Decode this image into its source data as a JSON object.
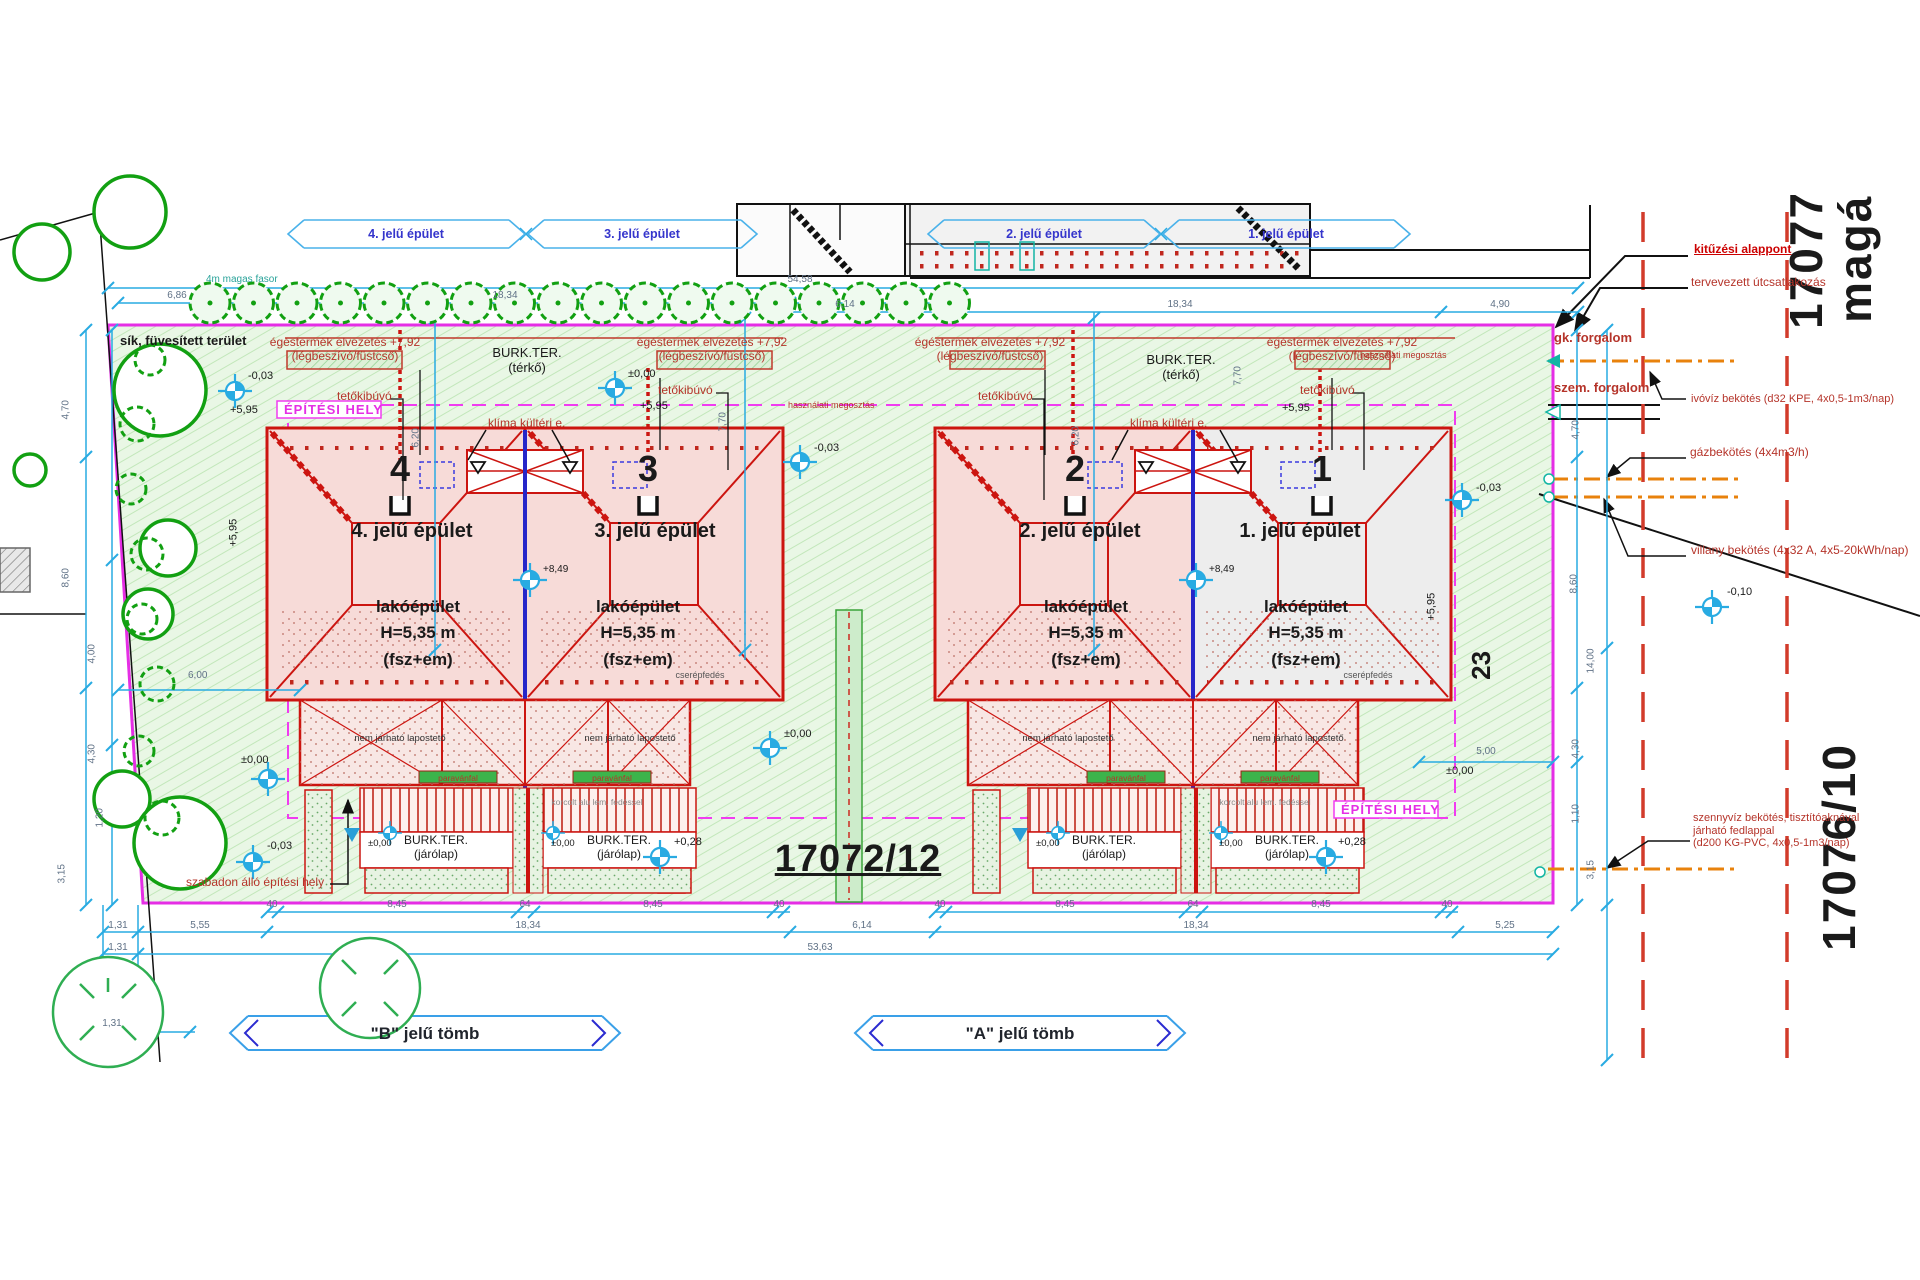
{
  "parcels": {
    "main": "17072/12",
    "right_top": "17077",
    "right_top2": "magá",
    "right_bottom": "17076/10",
    "neighbor": "23"
  },
  "callouts": {
    "b4": "4. jelű épület",
    "b3": "3. jelű épület",
    "b2": "2. jelű épület",
    "b1": "1. jelű épület"
  },
  "blocks": {
    "b": "\"B\" jelű tömb",
    "a": "\"A\" jelű tömb"
  },
  "buildings": [
    {
      "num": "4",
      "name": "4. jelű épület",
      "l1": "lakóépület",
      "l2": "H=5,35 m",
      "l3": "(fsz+em)"
    },
    {
      "num": "3",
      "name": "3. jelű épület",
      "l1": "lakóépület",
      "l2": "H=5,35 m",
      "l3": "(fsz+em)"
    },
    {
      "num": "2",
      "name": "2. jelű épület",
      "l1": "lakóépület",
      "l2": "H=5,35 m",
      "l3": "(fsz+em)"
    },
    {
      "num": "1",
      "name": "1. jelű épület",
      "l1": "lakóépület",
      "l2": "H=5,35 m",
      "l3": "(fsz+em)"
    }
  ],
  "site": {
    "grass": "sík, füvesített terület",
    "zone": "ÉPÍTÉSI HELY",
    "free": "szabadon álló építési hely",
    "tree_row": "4m magas fasor",
    "split": "használati megosztás",
    "terko1": "BURK.TER.",
    "terko2": "(térkő)",
    "jarolap1": "BURK.TER.",
    "jarolap2": "(járólap)",
    "flat": "nem járható lapostető",
    "tile": "cserépfedés",
    "alu": "korcolt alu lem. fedéssel",
    "screen": "paravánfal",
    "hatch": "tetőkibúvó",
    "flue1": "égéstermék elvezetés +7,92",
    "flue2": "(légbeszívó/füstcső)",
    "ac": "klíma kültéri e."
  },
  "utilities": {
    "setout": "kitűzési alappont",
    "road": "tervevezett útcsatlakozás",
    "car": "gk. forgalom",
    "ped": "szem. forgalom",
    "water": "ivóvíz bekötés (d32 KPE, 4x0,5-1m3/nap)",
    "gas": "gázbekötés (4x4m3/h)",
    "power": "villany bekötés (4x32 A, 4x5-20kWh/nap)",
    "sewer1": "szennyvíz bekötés, tisztítóaknával",
    "sewer2": "járható fedlappal",
    "sewer3": "(d200 KG-PVC, 4x0,5-1m3/nap)"
  },
  "levels": {
    "zero": "±0,00",
    "m003": "-0,03",
    "m010": "-0,10",
    "p028": "+0,28",
    "p595": "+5,95",
    "p849": "+8,49"
  },
  "dims": {
    "d40": "40",
    "d64": "64",
    "d845": "8,45",
    "d1834": "18,34",
    "d614": "6,14",
    "d131": "1,31",
    "d555": "5,55",
    "d5363": "53,63",
    "d525": "5,25",
    "d5458": "54,58",
    "d686": "6,86",
    "d490": "4,90",
    "d470": "4,70",
    "d860": "8,60",
    "d400": "4,00",
    "d430": "4,30",
    "d120": "1,20",
    "d315": "3,15",
    "d600": "6,00",
    "d620": "6,20",
    "d770": "7,70",
    "d1400": "14,00",
    "d110": "1,10",
    "d500": "5,00"
  },
  "colors": {
    "boundary": "#e52ee5",
    "building": "#cc1510",
    "dimline": "#29abe2",
    "utility": "#e8820c",
    "tree": "#16a016"
  }
}
